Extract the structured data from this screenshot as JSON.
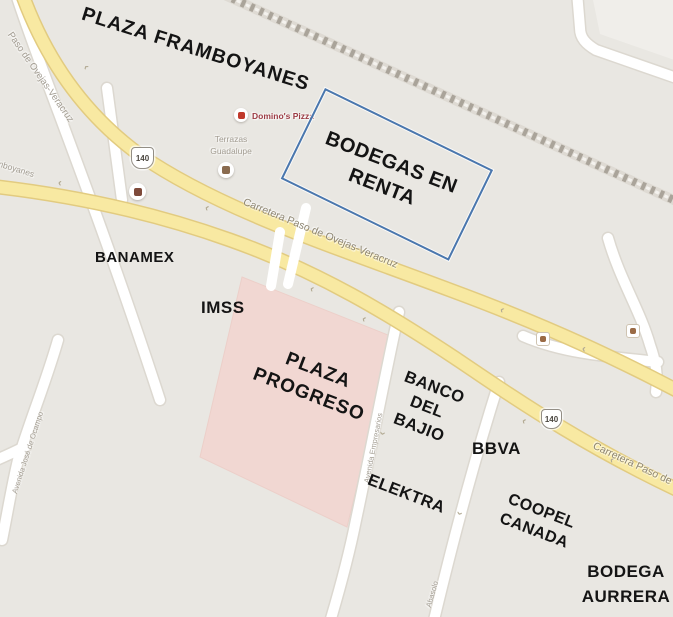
{
  "overlays": {
    "plaza_framboyanes": "PLAZA FRAMBOYANES",
    "bodegas": {
      "line1": "BODEGAS",
      "line2": "EN RENTA"
    },
    "banamex": "BANAMEX",
    "imss": "IMSS",
    "plaza_progreso": {
      "line1": "PLAZA",
      "line2": "PROGRESO"
    },
    "banco_del_bajio": {
      "line1": "BANCO",
      "line2": "DEL",
      "line3": "BAJIO"
    },
    "bbva": "BBVA",
    "elektra": "ELEKTRA",
    "coopel_canada": {
      "line1": "COOPEL",
      "line2": "CANADA"
    },
    "bodega_aurrera": {
      "line1": "BODEGA",
      "line2": "AURRERA"
    }
  },
  "map": {
    "road_labels": {
      "carretera": "Carretera Paso de Ovejas-Veracruz",
      "paso_de_ovejas": "Paso de Ovejas-Veracruz",
      "avenida_jose": "Avenida José de Ocampo",
      "avenida_empresarios": "Avenida Empresarios",
      "abasolo": "Abasolo",
      "framboyanes_fragment": "mboyanes",
      "highway_number": "140"
    },
    "pois": {
      "dominos": "Domino's Pizza",
      "terrazas": {
        "line1": "Terrazas",
        "line2": "Guadalupe"
      }
    },
    "icons": {
      "one_way_arrow": "‹"
    },
    "colors": {
      "background": "#e9e7e2",
      "road_yellow": "#f8e9a2",
      "road_yellow_casing": "#e2cb80",
      "plaza_pink": "#f1d7d2",
      "railroad_gray": "#aaa49a",
      "annotation_box_blue": "#4a77ae",
      "dominos_red": "#9c3b44"
    }
  }
}
